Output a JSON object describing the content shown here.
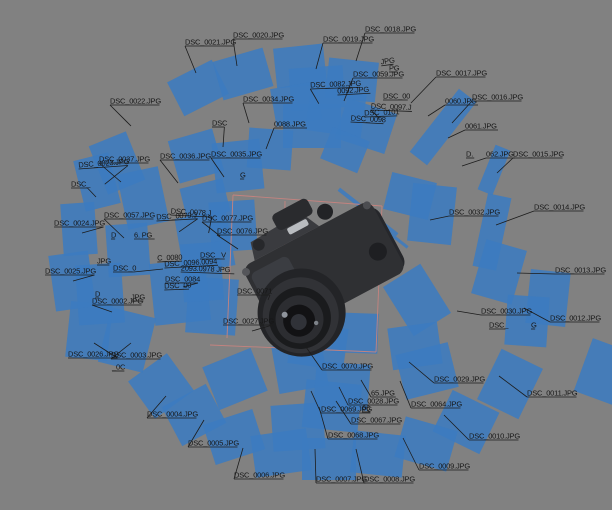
{
  "scene": {
    "width": 612,
    "height": 510,
    "background_color": "#818181",
    "plane_color": "#3c7bc0",
    "plane_opacity": 0.87,
    "label_color": "#161616",
    "leader_line_color": "#1c1c1c",
    "region_box_color": "#c4837f",
    "font_size": 7.5,
    "description": "photogrammetry-model-view-with-camera-poses"
  },
  "region_box": {
    "lines": [
      [
        233,
        195,
        382,
        206
      ],
      [
        382,
        206,
        376,
        352
      ],
      [
        285,
        201,
        283,
        351
      ],
      [
        210,
        345,
        376,
        352
      ],
      [
        233,
        195,
        227,
        338
      ]
    ]
  },
  "camera_planes": [
    [
      198,
      88,
      50,
      38,
      -27
    ],
    [
      243,
      74,
      52,
      40,
      -16
    ],
    [
      300,
      66,
      50,
      40,
      -6
    ],
    [
      317,
      88,
      54,
      42,
      -4
    ],
    [
      352,
      80,
      50,
      40,
      6
    ],
    [
      296,
      104,
      46,
      38,
      -10
    ],
    [
      336,
      112,
      56,
      44,
      8
    ],
    [
      366,
      126,
      52,
      42,
      18
    ],
    [
      312,
      126,
      58,
      44,
      0
    ],
    [
      345,
      150,
      40,
      34,
      22
    ],
    [
      443,
      127,
      22,
      80,
      38
    ],
    [
      494,
      170,
      16,
      48,
      22
    ],
    [
      492,
      232,
      24,
      74,
      12
    ],
    [
      432,
      214,
      44,
      58,
      6
    ],
    [
      499,
      272,
      42,
      56,
      16
    ],
    [
      548,
      298,
      40,
      54,
      6
    ],
    [
      417,
      300,
      44,
      58,
      -32
    ],
    [
      527,
      321,
      42,
      50,
      4
    ],
    [
      604,
      372,
      44,
      56,
      20
    ],
    [
      510,
      384,
      46,
      56,
      26
    ],
    [
      427,
      371,
      54,
      46,
      -14
    ],
    [
      466,
      422,
      52,
      46,
      26
    ],
    [
      426,
      444,
      54,
      42,
      16
    ],
    [
      378,
      454,
      52,
      42,
      6
    ],
    [
      329,
      459,
      54,
      42,
      0
    ],
    [
      281,
      453,
      56,
      42,
      -8
    ],
    [
      234,
      437,
      52,
      42,
      -18
    ],
    [
      194,
      415,
      50,
      44,
      -28
    ],
    [
      161,
      386,
      48,
      46,
      -36
    ],
    [
      89,
      331,
      42,
      56,
      6
    ],
    [
      127,
      340,
      46,
      56,
      14
    ],
    [
      100,
      294,
      46,
      60,
      -4
    ],
    [
      72,
      281,
      40,
      56,
      -8
    ],
    [
      79,
      229,
      34,
      52,
      -4
    ],
    [
      97,
      182,
      36,
      52,
      -14
    ],
    [
      117,
      163,
      40,
      52,
      -22
    ],
    [
      143,
      198,
      42,
      56,
      -12
    ],
    [
      128,
      250,
      42,
      52,
      -4
    ],
    [
      196,
      156,
      46,
      44,
      -16
    ],
    [
      238,
      166,
      48,
      50,
      -6
    ],
    [
      270,
      149,
      44,
      40,
      4
    ],
    [
      205,
      242,
      52,
      56,
      -10
    ],
    [
      233,
      226,
      46,
      50,
      -4
    ],
    [
      180,
      292,
      56,
      62,
      -6
    ],
    [
      212,
      306,
      50,
      56,
      4
    ],
    [
      318,
      346,
      56,
      42,
      8
    ],
    [
      235,
      379,
      52,
      46,
      -22
    ],
    [
      205,
      200,
      44,
      34,
      -14
    ],
    [
      202,
      272,
      40,
      58,
      -4
    ],
    [
      410,
      196,
      46,
      38,
      14
    ],
    [
      415,
      346,
      50,
      42,
      -8
    ],
    [
      355,
      333,
      46,
      40,
      2
    ],
    [
      300,
      366,
      50,
      48,
      -10
    ],
    [
      332,
      406,
      56,
      48,
      6
    ],
    [
      298,
      427,
      52,
      46,
      -4
    ],
    [
      342,
      386,
      54,
      46,
      4
    ],
    [
      368,
      212,
      74,
      4,
      38
    ],
    [
      384,
      229,
      60,
      3,
      38
    ]
  ],
  "photo_labels": [
    [
      "DSC_0021.JPG",
      185,
      37,
      196,
      73,
      0
    ],
    [
      "DSC_0020.JPG",
      233,
      30,
      237,
      66,
      0
    ],
    [
      "DSC_0018.JPG",
      365,
      24,
      356,
      61,
      0
    ],
    [
      "DSC_0019.JPG",
      323,
      34,
      316,
      69,
      0
    ],
    [
      "DSC_0022.JPG",
      110,
      96,
      131,
      126,
      0
    ],
    [
      "DSC_0034.JPG",
      243,
      94,
      249,
      123,
      0
    ],
    [
      "DSC",
      212,
      118,
      223,
      147,
      0
    ],
    [
      "0088.JPG",
      274,
      119,
      266,
      149,
      0
    ],
    [
      "DSC_0059.JPG",
      353,
      69,
      344,
      101,
      0
    ],
    [
      "DSC_0017.JPG",
      436,
      68,
      411,
      103,
      0
    ],
    [
      "DSC_0082.JPG",
      310,
      80,
      318,
      104,
      -2
    ],
    [
      "0092.JPG",
      337,
      86,
      null,
      null,
      -3
    ],
    [
      "DSC_00",
      383,
      91,
      null,
      null,
      0
    ],
    [
      "DSC_0097.J",
      371,
      101,
      380,
      118,
      2
    ],
    [
      "DSC_0101",
      364,
      108,
      null,
      null,
      -2
    ],
    [
      "DSC_0098",
      351,
      113,
      null,
      null,
      3
    ],
    [
      "JPG",
      380,
      57,
      null,
      null,
      -8
    ],
    [
      "PG",
      389,
      63,
      null,
      null,
      0
    ],
    [
      "DSC_0016.JPG",
      472,
      92,
      452,
      123,
      0
    ],
    [
      "0060.JPG",
      445,
      96,
      428,
      116,
      0
    ],
    [
      "0061.JPG",
      465,
      121,
      448,
      138,
      0
    ],
    [
      "D.",
      466,
      149,
      null,
      null,
      0
    ],
    [
      "062.JPG",
      486,
      149,
      462,
      166,
      0
    ],
    [
      "DSC_0015.JPG",
      513,
      149,
      497,
      173,
      0
    ],
    [
      "DSC_0014.JPG",
      534,
      202,
      496,
      225,
      0
    ],
    [
      "DSC_0032.JPG",
      449,
      207,
      430,
      220,
      0
    ],
    [
      "DSC_0013.JPG",
      555,
      265,
      517,
      273,
      0
    ],
    [
      "DSC_0012.JPG",
      550,
      313,
      524,
      308,
      0
    ],
    [
      "DSC_0030.JPG",
      481,
      306,
      457,
      311,
      0
    ],
    [
      "DSC_",
      489,
      320,
      null,
      null,
      0
    ],
    [
      "G",
      531,
      320,
      null,
      null,
      0
    ],
    [
      "DSC_0011.JPG",
      527,
      388,
      499,
      376,
      0
    ],
    [
      "DSC_0029.JPG",
      434,
      374,
      409,
      362,
      0
    ],
    [
      "DSC_0010.JPG",
      469,
      431,
      444,
      415,
      0
    ],
    [
      "DSC_0009.JPG",
      419,
      461,
      403,
      438,
      0
    ],
    [
      "DSC_0008.JPG",
      364,
      474,
      356,
      449,
      0
    ],
    [
      "DSC_0007.JPG",
      316,
      474,
      315,
      449,
      0
    ],
    [
      "DSC_0006.JPG",
      234,
      470,
      243,
      448,
      0
    ],
    [
      "DSC_0005.JPG",
      188,
      438,
      204,
      420,
      0
    ],
    [
      "DSC_0004.JPG",
      147,
      409,
      166,
      396,
      0
    ],
    [
      "DSC_0026.JPG",
      68,
      349,
      94,
      343,
      0
    ],
    [
      "DSC_0003.JPG",
      111,
      350,
      131,
      343,
      0
    ],
    [
      "_0C",
      112,
      362,
      null,
      null,
      0
    ],
    [
      "DSC_0025.JPG",
      45,
      266,
      73,
      281,
      0
    ],
    [
      "DSC_0024.JPG",
      54,
      218,
      82,
      233,
      0
    ],
    [
      "DSC_",
      71,
      179,
      96,
      197,
      0
    ],
    [
      "DSC_0023.JPG",
      78,
      160,
      103,
      186,
      -4
    ],
    [
      "DSC_0037.JPG",
      99,
      154,
      121,
      182,
      0
    ],
    [
      "DSC_0036.JPG",
      160,
      151,
      178,
      183,
      0
    ],
    [
      "DSC_0035.JPG",
      211,
      149,
      224,
      177,
      0
    ],
    [
      "G",
      240,
      170,
      null,
      null,
      0
    ],
    [
      "DSC_0057.JPG",
      104,
      210,
      124,
      238,
      0
    ],
    [
      "D",
      111,
      230,
      null,
      null,
      0
    ],
    [
      "6. PG",
      134,
      230,
      null,
      null,
      0
    ],
    [
      "DSC_0078.J",
      171,
      206,
      210,
      231,
      3
    ],
    [
      "DSC_0079.J",
      156,
      212,
      178,
      233,
      -3
    ],
    [
      "DSC_0077.JPG",
      202,
      213,
      220,
      236,
      0
    ],
    [
      "DSC_0076.JPG",
      217,
      226,
      238,
      249,
      0
    ],
    [
      "JPG",
      97,
      256,
      null,
      null,
      0
    ],
    [
      "DSC_0",
      113,
      263,
      163,
      269,
      0
    ],
    [
      "C_0080",
      157,
      253,
      null,
      null,
      -2
    ],
    [
      "DSC_ V",
      200,
      250,
      null,
      null,
      0
    ],
    [
      "DSC_0096.0094",
      164,
      259,
      null,
      null,
      -3
    ],
    [
      "2093.0978 JPG",
      181,
      263,
      null,
      null,
      2
    ],
    [
      "DSC_0084",
      165,
      274,
      183,
      287,
      0
    ],
    [
      "DSC_00",
      164,
      281,
      null,
      null,
      -2
    ],
    [
      "D",
      95,
      289,
      null,
      null,
      0
    ],
    [
      "DSC_0002.JPG",
      92,
      296,
      112,
      312,
      0
    ],
    [
      "JPG",
      131,
      292,
      null,
      null,
      0
    ],
    [
      "DSC_0071",
      237,
      286,
      268,
      300,
      0
    ],
    [
      "DSC_0027.JPG",
      223,
      316,
      252,
      331,
      0
    ],
    [
      "DSC_0070.JPG",
      322,
      361,
      306,
      347,
      0
    ],
    [
      "65.JPG",
      371,
      388,
      361,
      380,
      0
    ],
    [
      "DSC_0028.JPG",
      348,
      396,
      339,
      387,
      0
    ],
    [
      "66",
      362,
      403,
      null,
      null,
      0
    ],
    [
      "DSC_0069.JPG",
      321,
      404,
      311,
      391,
      0
    ],
    [
      "DSC_0067.JPG",
      351,
      415,
      336,
      401,
      0
    ],
    [
      "DSC_0068.JPG",
      328,
      430,
      319,
      407,
      0
    ],
    [
      "DSC_0064.JPG",
      411,
      399,
      400,
      381,
      0
    ]
  ]
}
